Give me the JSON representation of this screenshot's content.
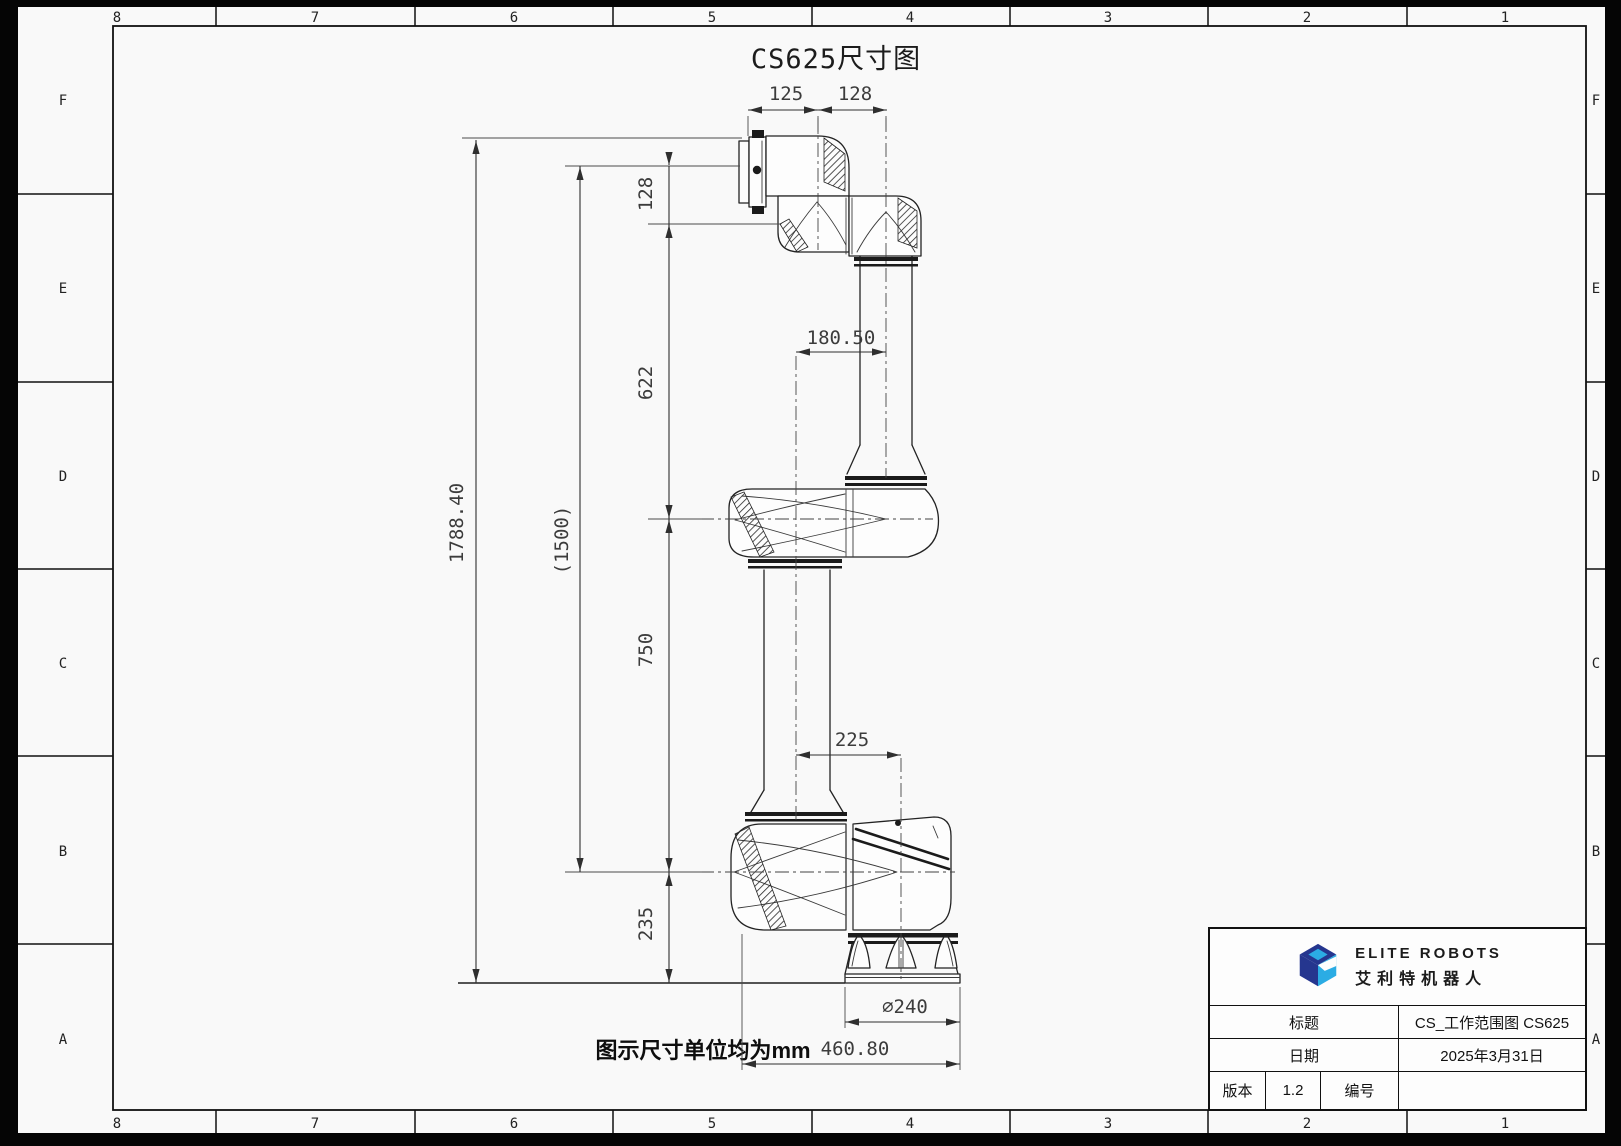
{
  "frame": {
    "paper": "#f9f9f9",
    "background": "#050505",
    "line_color": "#1e1e1e",
    "zone_columns": [
      "8",
      "7",
      "6",
      "5",
      "4",
      "3",
      "2",
      "1"
    ],
    "zone_rows": [
      "F",
      "E",
      "D",
      "C",
      "B",
      "A"
    ]
  },
  "drawing": {
    "title": "CS625尺寸图",
    "caption": "图示尺寸单位均为mm"
  },
  "dims": {
    "d125": "125",
    "d128_top": "128",
    "d128_seg": "128",
    "d622": "622",
    "d750": "750",
    "d235": "235",
    "d1788": "1788.40",
    "d1500": "(1500)",
    "d180": "180.50",
    "d225": "225",
    "d240": "∅240",
    "d460": "460.80"
  },
  "title_block": {
    "brand_en": "ELITE ROBOTS",
    "brand_cn": "艾利特机器人",
    "logo_navy": "#25368f",
    "logo_blue": "#2bace4",
    "title_label": "标题",
    "title_value": "CS_工作范围图 CS625",
    "date_label": "日期",
    "date_value": "2025年3月31日",
    "version_label": "版本",
    "version_value": "1.2",
    "number_label": "编号",
    "number_value": ""
  }
}
